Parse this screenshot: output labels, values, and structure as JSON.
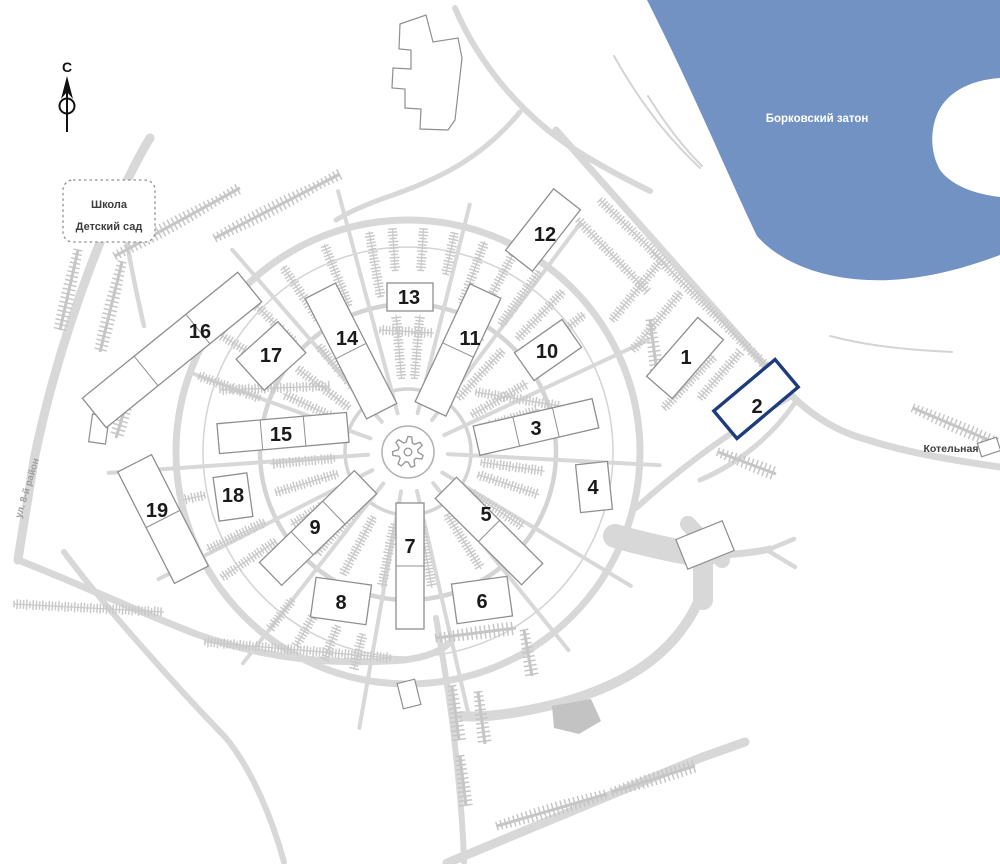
{
  "map": {
    "north": {
      "label": "С"
    },
    "school": {
      "line1": "Школа",
      "line2": "Детский сад"
    },
    "water": {
      "label": "Борковский затон",
      "color": "#7292c4",
      "label_color": "#ffffff"
    },
    "street": {
      "label": "ул. 8-й район"
    },
    "boiler": {
      "label": "Котельная"
    },
    "colors": {
      "road": "#d8d8d8",
      "road_thin": "#d4d4d4",
      "tree": "#c9c9c9",
      "comb": "#c6c6c6",
      "building_stroke": "#8f8f8f",
      "highlight": "#1e3c7c",
      "label_dark": "#1a1a1a",
      "street_label": "#9c9c9c"
    },
    "buildings": [
      {
        "label": "1",
        "x": 685,
        "y": 358,
        "w": 78,
        "h": 34,
        "angle": -49,
        "segs": 1,
        "lx": 686,
        "ly": 357,
        "highlighted": false
      },
      {
        "label": "2",
        "x": 756,
        "y": 399,
        "w": 80,
        "h": 36,
        "angle": -40,
        "segs": 1,
        "lx": 757,
        "ly": 406,
        "highlighted": true
      },
      {
        "label": "3",
        "x": 536,
        "y": 427,
        "w": 122,
        "h": 30,
        "angle": -13,
        "segs": 3,
        "lx": 536,
        "ly": 428,
        "highlighted": false
      },
      {
        "label": "4",
        "x": 594,
        "y": 487,
        "w": 32,
        "h": 48,
        "angle": -6,
        "segs": 1,
        "lx": 593,
        "ly": 487,
        "highlighted": false
      },
      {
        "label": "5",
        "x": 489,
        "y": 531,
        "w": 122,
        "h": 30,
        "angle": 45,
        "segs": 2,
        "lx": 486,
        "ly": 514,
        "highlighted": false
      },
      {
        "label": "6",
        "x": 482,
        "y": 600,
        "w": 56,
        "h": 40,
        "angle": -8,
        "segs": 1,
        "lx": 482,
        "ly": 601,
        "highlighted": false
      },
      {
        "label": "7",
        "x": 410,
        "y": 566,
        "w": 126,
        "h": 28,
        "angle": 90,
        "segs": 2,
        "lx": 410,
        "ly": 546,
        "highlighted": false
      },
      {
        "label": "8",
        "x": 341,
        "y": 601,
        "w": 56,
        "h": 40,
        "angle": 8,
        "segs": 1,
        "lx": 341,
        "ly": 602,
        "highlighted": false
      },
      {
        "label": "9",
        "x": 318,
        "y": 528,
        "w": 132,
        "h": 32,
        "angle": -44,
        "segs": 3,
        "lx": 315,
        "ly": 527,
        "highlighted": false
      },
      {
        "label": "10",
        "x": 548,
        "y": 350,
        "w": 58,
        "h": 34,
        "angle": -35,
        "segs": 1,
        "lx": 547,
        "ly": 351,
        "highlighted": false
      },
      {
        "label": "11",
        "x": 458,
        "y": 350,
        "w": 130,
        "h": 34,
        "angle": -65,
        "segs": 2,
        "lx": 470,
        "ly": 338,
        "highlighted": false
      },
      {
        "label": "12",
        "x": 543,
        "y": 230,
        "w": 78,
        "h": 34,
        "angle": -52,
        "segs": 1,
        "lx": 545,
        "ly": 234,
        "highlighted": false
      },
      {
        "label": "13",
        "x": 410,
        "y": 297,
        "w": 46,
        "h": 28,
        "angle": 0,
        "segs": 1,
        "lx": 409,
        "ly": 297,
        "highlighted": false
      },
      {
        "label": "14",
        "x": 351,
        "y": 351,
        "w": 135,
        "h": 34,
        "angle": 63,
        "segs": 2,
        "lx": 347,
        "ly": 338,
        "highlighted": false
      },
      {
        "label": "15",
        "x": 283,
        "y": 433,
        "w": 130,
        "h": 30,
        "angle": -5,
        "segs": 3,
        "lx": 281,
        "ly": 434,
        "highlighted": false
      },
      {
        "label": "16",
        "x": 172,
        "y": 350,
        "w": 200,
        "h": 38,
        "angle": -39,
        "segs": 3,
        "lx": 200,
        "ly": 331,
        "highlighted": false
      },
      {
        "label": "17",
        "x": 271,
        "y": 356,
        "w": 56,
        "h": 42,
        "angle": -42,
        "segs": 1,
        "lx": 271,
        "ly": 355,
        "highlighted": false
      },
      {
        "label": "18",
        "x": 233,
        "y": 497,
        "w": 34,
        "h": 44,
        "angle": -8,
        "segs": 1,
        "lx": 233,
        "ly": 495,
        "highlighted": false
      },
      {
        "label": "19",
        "x": 163,
        "y": 519,
        "w": 125,
        "h": 38,
        "angle": 63,
        "segs": 2,
        "lx": 157,
        "ly": 510,
        "highlighted": false
      }
    ]
  }
}
